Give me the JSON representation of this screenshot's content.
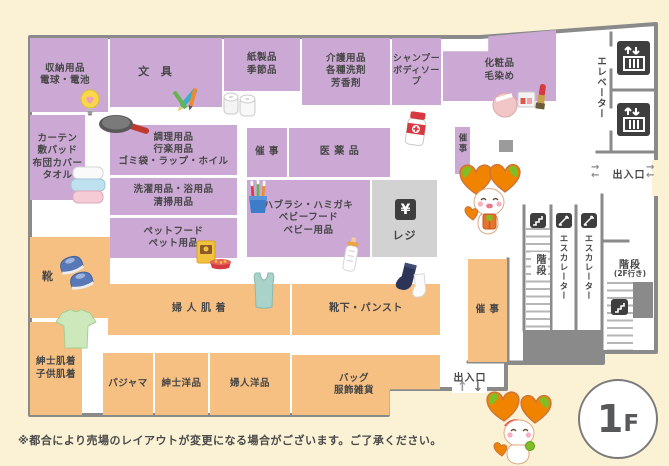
{
  "floor_badge": {
    "number": "1",
    "suffix": "F"
  },
  "note": "※都合により売場のレイアウトが変更になる場合がございます。ご了承ください。",
  "palette": {
    "background": "#FBF2D6",
    "floor": "#FFFFFF",
    "wall": "#8A8A8A",
    "department_household": "#CBA9D4",
    "department_clothing": "#F6C083",
    "register_area": "#D2D2D3",
    "facility_icon": "#3E3E3E",
    "text": "#474747"
  },
  "departments": {
    "storage": "収納用品\n電球・電池",
    "stationery": "文 具",
    "paper": "紙製品\n季節品",
    "care": "介護用品\n各種洗剤\n芳香剤",
    "shampoo": "シャンプー\nボディソープ",
    "cosmetics": "化粧品\n毛染め",
    "curtain": "カーテン\n敷パッド\n布団カバー\nタオル",
    "cooking": "調理用品\n行楽用品\nゴミ袋・ラップ・ホイル",
    "laundry": "洗濯用品・浴用品\n清掃用品",
    "pet": "ペットフード\nペット用品",
    "event_center": "催 事",
    "medicine": "医 薬 品",
    "babycare": "ハブラシ・ハミガキ\nベビーフード\nベビー用品",
    "event_strip": "催事",
    "shoes": "靴",
    "womens_underwear": "婦 人 肌 着",
    "socks": "靴下・パンスト",
    "event_right": "催 事",
    "mens_kids_underwear": "紳士肌着\n子供肌着",
    "pajama": "パジャマ",
    "mens_wear": "紳士洋品",
    "womens_wear": "婦人洋品",
    "bags": "バッグ\n服飾雑貨"
  },
  "facilities": {
    "elevator": "エレベーター",
    "escalator_left": "エスカレーター",
    "escalator_right": "エスカレーター",
    "stairs": "階段",
    "stairs_2f": "階段",
    "stairs_2f_note": "(2F行き)",
    "exit_right": "出入口",
    "exit_bottom": "出入口",
    "register": "レジ",
    "register_symbol": "¥",
    "arrow_up": "↑",
    "arrow_down": "↓",
    "arrow_right": "→",
    "arrow_left": "←"
  },
  "icons": {
    "decorative": [
      "lightbulb-icon",
      "stationery-icon",
      "paper-rolls-icon",
      "cosmetics-icon",
      "frying-pan-icon",
      "medicine-bottle-icon",
      "toothbrush-cup-icon",
      "towels-icon",
      "pet-food-icon",
      "baby-bottle-icon",
      "camisole-icon",
      "socks-icon",
      "shoes-icon",
      "tshirt-icon",
      "mascot-character"
    ],
    "facility": [
      "elevator-icon",
      "escalator-icon",
      "stairs-icon",
      "register-yen-icon"
    ]
  }
}
